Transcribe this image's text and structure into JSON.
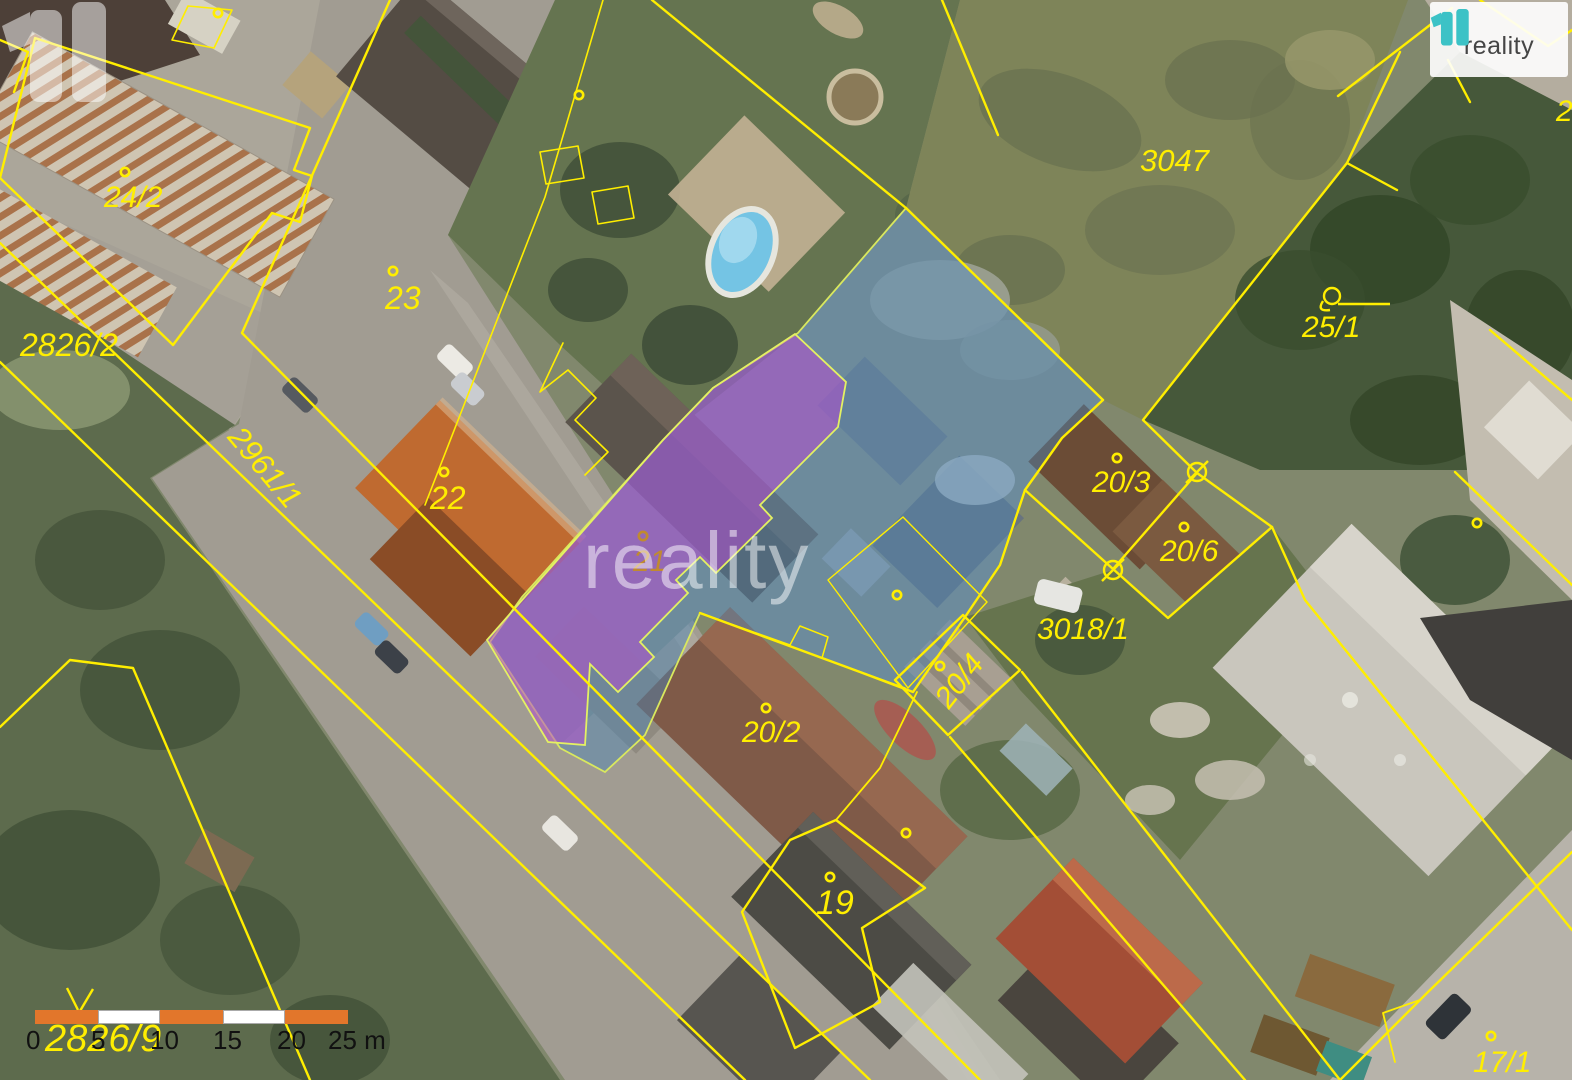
{
  "map_overlay": {
    "watermark": {
      "text": "reality"
    },
    "brand_logo": {
      "text": "reality",
      "glyph_color": "#3cc2c6",
      "text_color": "#454545"
    },
    "scale_bar": {
      "tick_labels": [
        "0",
        "5",
        "10",
        "15",
        "20",
        "25 m"
      ],
      "bar_color": "#e2762b",
      "alt_color": "#ffffff"
    },
    "line_color": "#ffee00",
    "highlights": {
      "primary_parcel": {
        "number": "21",
        "fill": "#b44fd0",
        "fill_opacity": 0.55,
        "outline": "#e4f162"
      },
      "secondary_area": {
        "fill": "#4b86b4",
        "fill_opacity": 0.46,
        "outline": "#d9e85e"
      }
    },
    "parcel_labels": [
      {
        "text": "24/2",
        "x": 104,
        "y": 207,
        "size": 30
      },
      {
        "text": "2826/2",
        "x": 20,
        "y": 356,
        "size": 32
      },
      {
        "text": "23",
        "x": 385,
        "y": 309,
        "size": 32
      },
      {
        "text": "2961/1",
        "x": 257,
        "y": 474,
        "size": 31,
        "rot": 50,
        "anchor": "middle"
      },
      {
        "text": "22",
        "x": 430,
        "y": 509,
        "size": 32
      },
      {
        "text": "21",
        "x": 633,
        "y": 571,
        "size": 30,
        "color": "#c08a30"
      },
      {
        "text": "3047",
        "x": 1140,
        "y": 171,
        "size": 31
      },
      {
        "text": "25/1",
        "x": 1302,
        "y": 337,
        "size": 30
      },
      {
        "text": "20/3",
        "x": 1092,
        "y": 492,
        "size": 30
      },
      {
        "text": "20/6",
        "x": 1160,
        "y": 561,
        "size": 30
      },
      {
        "text": "3018/1",
        "x": 1037,
        "y": 639,
        "size": 30
      },
      {
        "text": "20/4",
        "x": 967,
        "y": 687,
        "size": 30,
        "rot": -52,
        "anchor": "middle"
      },
      {
        "text": "20/2",
        "x": 742,
        "y": 742,
        "size": 30
      },
      {
        "text": "19",
        "x": 816,
        "y": 914,
        "size": 34
      },
      {
        "text": "17/1",
        "x": 1473,
        "y": 1072,
        "size": 30
      },
      {
        "text": "2826/9",
        "x": 45,
        "y": 1051,
        "size": 38
      },
      {
        "text": "2",
        "x": 1556,
        "y": 121,
        "size": 30
      }
    ],
    "marker_dots": [
      {
        "x": 125,
        "y": 172
      },
      {
        "x": 393,
        "y": 271
      },
      {
        "x": 444,
        "y": 472
      },
      {
        "x": 1117,
        "y": 458
      },
      {
        "x": 1184,
        "y": 527
      },
      {
        "x": 766,
        "y": 708
      },
      {
        "x": 940,
        "y": 666
      },
      {
        "x": 830,
        "y": 877
      },
      {
        "x": 1491,
        "y": 1036
      },
      {
        "x": 906,
        "y": 833
      },
      {
        "x": 897,
        "y": 595
      },
      {
        "x": 1477,
        "y": 523
      },
      {
        "x": 579,
        "y": 95
      },
      {
        "x": 218,
        "y": 13
      },
      {
        "x": 643,
        "y": 536,
        "color": "#c08a30"
      }
    ],
    "survey_symbols": {
      "crossed_circles": [
        {
          "x": 1197,
          "y": 472
        },
        {
          "x": 1113,
          "y": 570
        }
      ],
      "unfenced_symbol": {
        "x": 1332,
        "y": 296
      }
    }
  }
}
